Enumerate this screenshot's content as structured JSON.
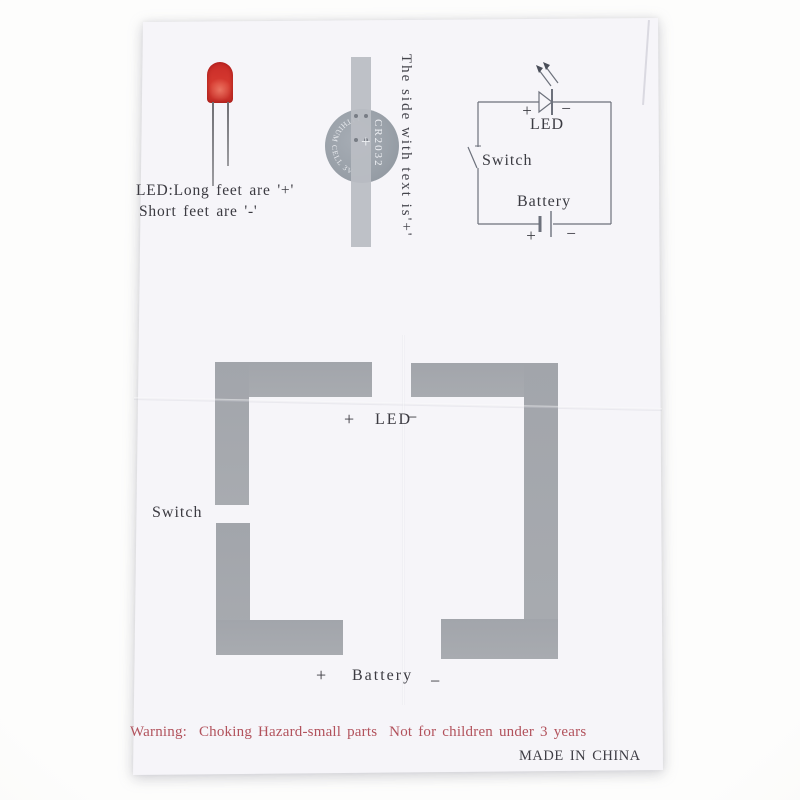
{
  "photo": {
    "background_color": "#fdfdfc",
    "paper_color": "#f6f5f9",
    "trace_color": "#a5a8ad",
    "battery_gray": "#99a1a9",
    "led_red": "#cd322c",
    "warning_red": "#b2525c",
    "ink_color": "#3b3a41"
  },
  "led_guide": {
    "line1": "LED:Long feet are '+'",
    "line2": "Short feet are '-'"
  },
  "battery_guide": {
    "model": "CR2032",
    "plus": "+",
    "edge_text": "LITHIUM CELL 3V",
    "caption": "The side with text is'+'"
  },
  "schematic": {
    "plus": "+",
    "minus": "−",
    "led_label": "LED",
    "switch_label": "Switch",
    "battery_label": "Battery"
  },
  "template": {
    "led_plus": "+",
    "led_label": "LED",
    "led_minus": "−",
    "switch_label": "Switch",
    "battery_plus": "+",
    "battery_label": "Battery",
    "battery_minus": "−"
  },
  "footer": {
    "warning": "Warning:  Choking Hazard-small parts  Not for children under 3 years",
    "made_in": "MADE IN CHINA"
  }
}
